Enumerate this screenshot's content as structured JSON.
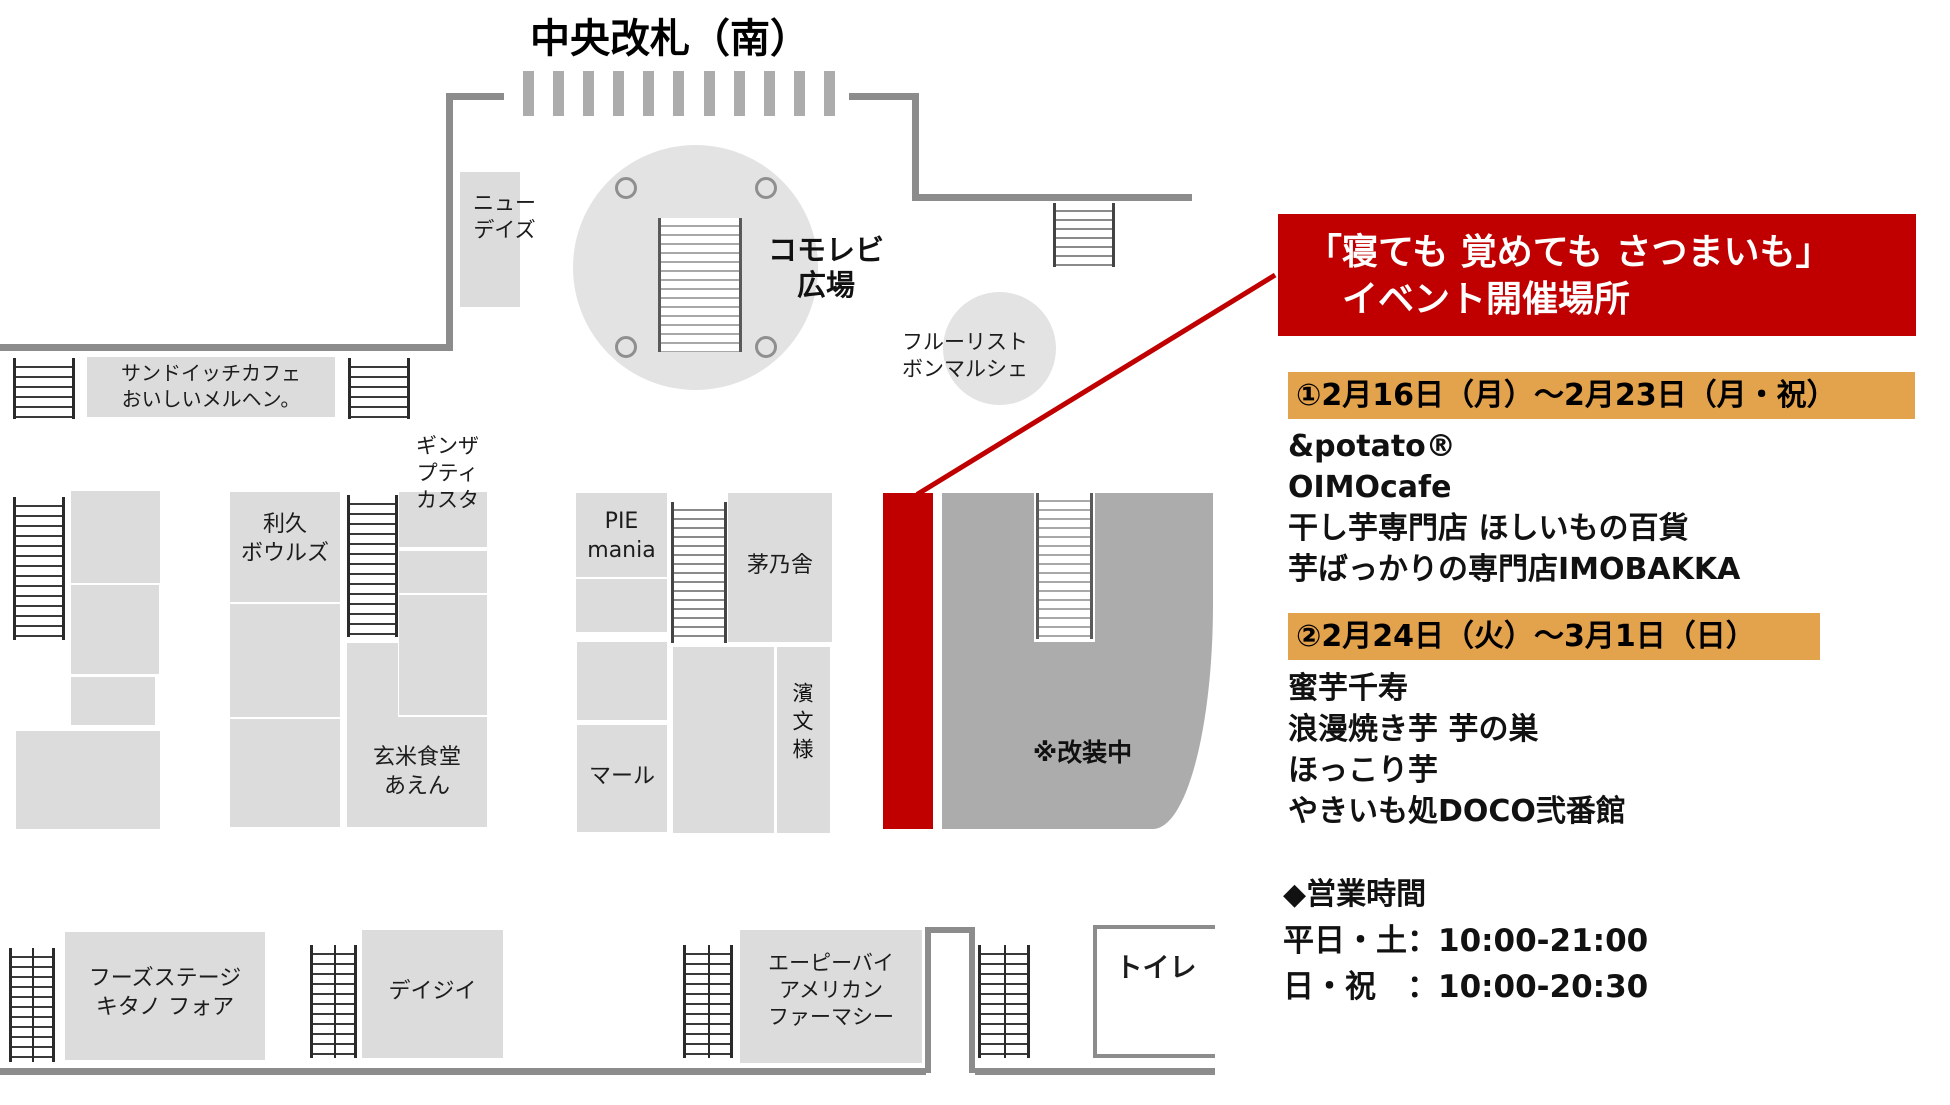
{
  "title": "中央改札（南）",
  "colors": {
    "accent_red": "#C00000",
    "highlight_orange": "#E3A24C",
    "shop_gray": "#DCDCDC",
    "renovation_gray": "#ACACAC"
  },
  "map": {
    "plaza_label": "コモレビ\n広場",
    "newdays": "ニュー\nデイズ",
    "fleuriste": "フルーリスト\nボンマルシェ",
    "sandwich_cafe": "サンドイッチカフェ\nおいしいメルヘン。",
    "ginza_petit_custa": "ギンザ\nプティ\nカスタ",
    "rikyu_bowls": "利久\nボウルズ",
    "genmai_shokudo": "玄米食堂\nあえん",
    "pie_mania": "PIE\nmania",
    "kayanoya": "茅乃舎",
    "marl": "マール",
    "hamamonyo": "濱文様",
    "renovation": "※改装中",
    "foods_stage": "フーズステージ\nキタノ フォア",
    "daisy": "デイジイ",
    "american_pharmacy": "エーピーバイ\nアメリカン\nファーマシー",
    "toilet": "トイレ"
  },
  "panel": {
    "banner": {
      "line1": "「寝ても 覚めても さつまいも」",
      "line2": "イベント開催場所"
    },
    "sections": [
      {
        "header": "①2月16日（月）～2月23日（月・祝）",
        "shops": [
          "&potato®",
          "OIMOcafe",
          "干し芋専門店 ほしいもの百貨",
          "芋ばっかりの専門店IMOBAKKA"
        ]
      },
      {
        "header": "②2月24日（火）～3月1日（日）",
        "shops": [
          "蜜芋千寿",
          "浪漫焼き芋 芋の巣",
          "ほっこり芋",
          "やきいも処DOCO弐番館"
        ]
      }
    ],
    "hours": {
      "title": "◆営業時間",
      "weekday": "平日・土：10:00-21:00",
      "sunday": "日・祝　：10:00-20:30"
    }
  }
}
